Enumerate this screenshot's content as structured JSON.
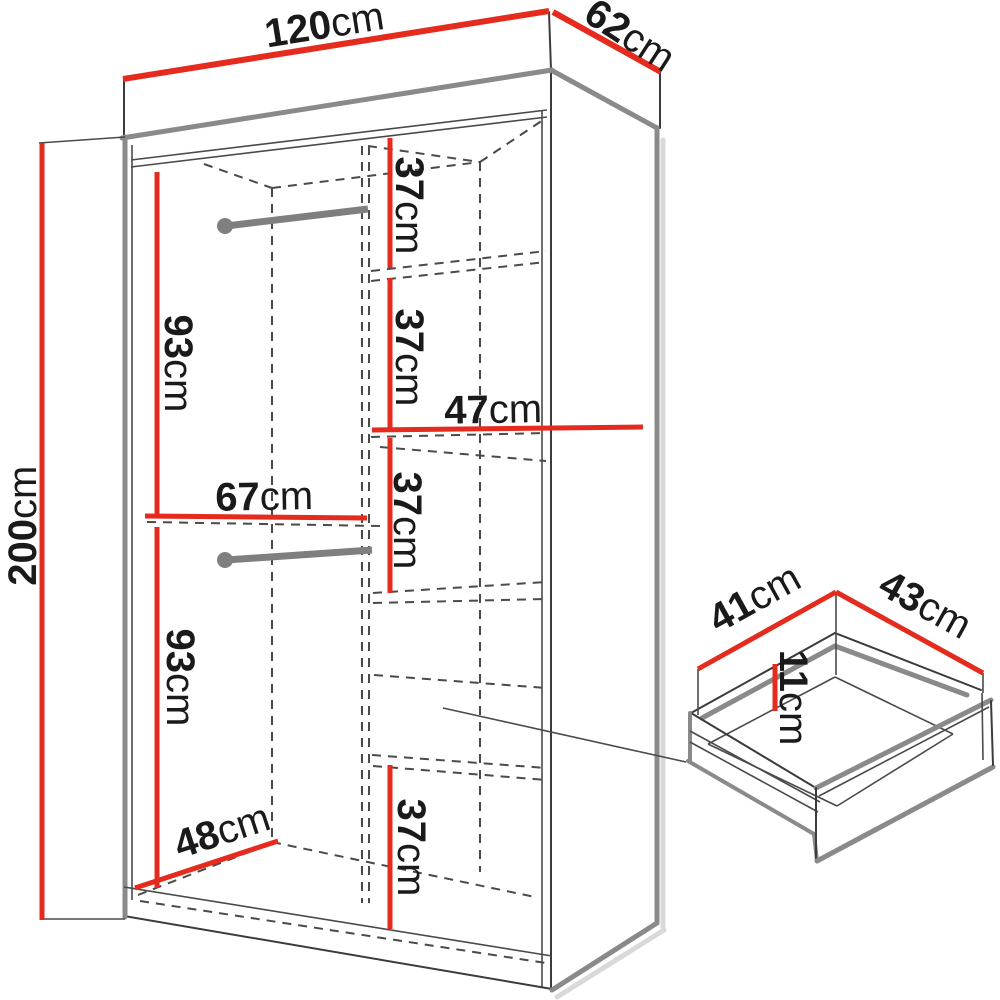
{
  "diagram": {
    "type": "furniture-dimension-drawing",
    "subject": "sliding-door wardrobe with interior layout and drawer detail",
    "colors": {
      "dimension_red": "#e42b1e",
      "panel_gray": "#8a8a8a",
      "line_dark": "#3b3b3b",
      "text": "#1a1a1a"
    },
    "dims": {
      "width": {
        "num": "120",
        "unit": "cm"
      },
      "depth": {
        "num": "62",
        "unit": "cm"
      },
      "height": {
        "num": "200",
        "unit": "cm"
      },
      "hang_upper": {
        "num": "93",
        "unit": "cm"
      },
      "hang_lower": {
        "num": "93",
        "unit": "cm"
      },
      "left_width": {
        "num": "67",
        "unit": "cm"
      },
      "floor_depth": {
        "num": "48",
        "unit": "cm"
      },
      "shelf_width": {
        "num": "47",
        "unit": "cm"
      },
      "shelf_h1": {
        "num": "37",
        "unit": "cm"
      },
      "shelf_h2": {
        "num": "37",
        "unit": "cm"
      },
      "shelf_h3": {
        "num": "37",
        "unit": "cm"
      },
      "shelf_h4": {
        "num": "37",
        "unit": "cm"
      },
      "drawer_width": {
        "num": "41",
        "unit": "cm"
      },
      "drawer_depth": {
        "num": "43",
        "unit": "cm"
      },
      "drawer_height": {
        "num": "11",
        "unit": "cm"
      }
    }
  }
}
